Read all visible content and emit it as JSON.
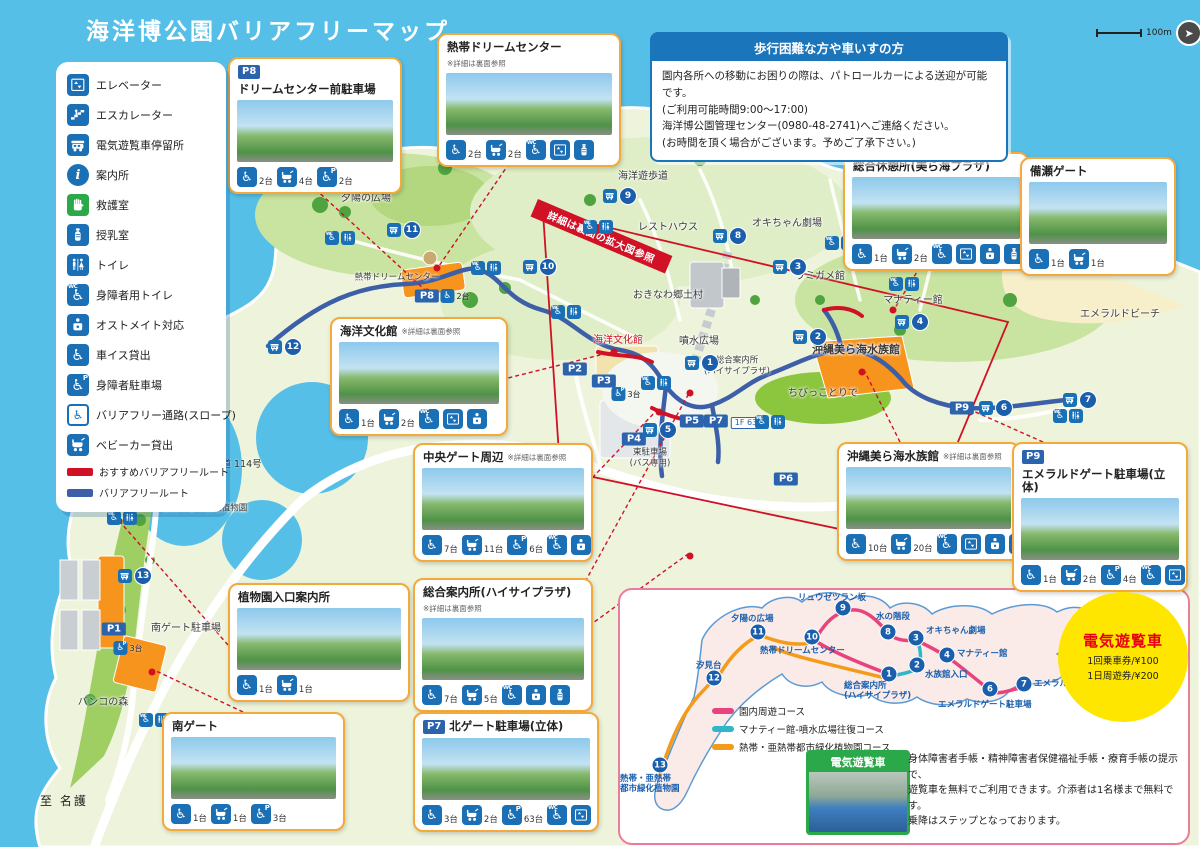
{
  "title": "海洋博公園バリアフリーマップ",
  "scale": {
    "label": "100m"
  },
  "colors": {
    "sea": "#56BFE8",
    "icon_blue": "#1B6FB5",
    "badge_blue": "#2B63AD",
    "recommended_route": "#D01126",
    "barrier_free_route": "#3D5FA8",
    "callout_border": "#F3A93C",
    "fare_circle": "#FFE600",
    "fare_title": "#E60012"
  },
  "legend": {
    "items": [
      {
        "icon": "elevator",
        "label": "エレベーター"
      },
      {
        "icon": "escalator",
        "label": "エスカレーター"
      },
      {
        "icon": "cart",
        "label": "電気遊覧車停留所"
      },
      {
        "icon": "info",
        "label": "案内所"
      },
      {
        "icon": "firstaid",
        "label": "救護室"
      },
      {
        "icon": "nursing",
        "label": "授乳室"
      },
      {
        "icon": "toilet",
        "label": "トイレ"
      },
      {
        "icon": "accessible-toilet",
        "label": "身障者用トイレ"
      },
      {
        "icon": "ostomate",
        "label": "オストメイト対応"
      },
      {
        "icon": "wheelchair",
        "label": "車イス貸出"
      },
      {
        "icon": "accessible-parking",
        "label": "身障者駐車場"
      },
      {
        "icon": "slope",
        "label": "バリアフリー通路(スロープ)"
      },
      {
        "icon": "stroller",
        "label": "ベビーカー貸出"
      }
    ],
    "routes": [
      {
        "label": "おすすめバリアフリールート",
        "color": "#D01126"
      },
      {
        "label": "バリアフリールート",
        "color": "#3D5FA8"
      }
    ]
  },
  "notice": {
    "title": "歩行困難な方や車いすの方",
    "lines": [
      "園内各所への移動にお困りの際は、パトロールカーによる送迎が可能です。",
      "(ご利用可能時間9:00〜17:00)",
      "海洋博公園管理センター(0980-48-2741)へご連絡ください。",
      "(お時間を頂く場合がございます。予めご了承下さい。)"
    ]
  },
  "map": {
    "zoom_banner": "詳細は裏面の拡大図参照",
    "edge_labels": {
      "to_nago": "至 名護",
      "to_nakijin": "至 今帰仁",
      "kendo_badge": "14",
      "kendo": "県道 114号"
    },
    "labels": [
      {
        "text": "夕陽の広場",
        "x": 366,
        "y": 199,
        "cls": ""
      },
      {
        "text": "熱帯ドリームセンター",
        "x": 397,
        "y": 278,
        "cls": "small"
      },
      {
        "text": "海洋遊歩道",
        "x": 643,
        "y": 177,
        "cls": ""
      },
      {
        "text": "レストハウス",
        "x": 668,
        "y": 228,
        "cls": ""
      },
      {
        "text": "オキちゃん劇場",
        "x": 787,
        "y": 224,
        "cls": ""
      },
      {
        "text": "ウミガメ館",
        "x": 820,
        "y": 277,
        "cls": ""
      },
      {
        "text": "マナティー館",
        "x": 913,
        "y": 301,
        "cls": ""
      },
      {
        "text": "おきなわ郷土村",
        "x": 668,
        "y": 296,
        "cls": ""
      },
      {
        "text": "海洋文化館",
        "x": 618,
        "y": 341,
        "cls": "red"
      },
      {
        "text": "噴水広場",
        "x": 699,
        "y": 342,
        "cls": ""
      },
      {
        "text": "総合案内所\n(ハイサイプラザ)",
        "x": 737,
        "y": 366,
        "cls": "small"
      },
      {
        "text": "沖縄美ら海水族館",
        "x": 856,
        "y": 350,
        "cls": "bold"
      },
      {
        "text": "ちびっことりで",
        "x": 823,
        "y": 394,
        "cls": ""
      },
      {
        "text": "エメラルドビーチ",
        "x": 1120,
        "y": 315,
        "cls": ""
      },
      {
        "text": "東駐車場\n(バス専用)",
        "x": 650,
        "y": 458,
        "cls": "small"
      },
      {
        "text": "熱帯・亜熱帯都市緑化植物園",
        "x": 192,
        "y": 509,
        "cls": "small"
      },
      {
        "text": "南ゲート駐車場",
        "x": 186,
        "y": 629,
        "cls": ""
      },
      {
        "text": "バンコの森",
        "x": 103,
        "y": 703,
        "cls": ""
      },
      {
        "text": "1F 63台",
        "x": 750,
        "y": 423,
        "cls": "whitebox"
      }
    ],
    "parking_badges": [
      {
        "id": "P1",
        "x": 114,
        "y": 629
      },
      {
        "id": "P2",
        "x": 575,
        "y": 369
      },
      {
        "id": "P3",
        "x": 604,
        "y": 381
      },
      {
        "id": "P4",
        "x": 634,
        "y": 439
      },
      {
        "id": "P5",
        "x": 692,
        "y": 421
      },
      {
        "id": "P6",
        "x": 786,
        "y": 479
      },
      {
        "id": "P7",
        "x": 716,
        "y": 421
      },
      {
        "id": "P8",
        "x": 427,
        "y": 296
      },
      {
        "id": "P9",
        "x": 962,
        "y": 408
      }
    ],
    "extra_counts": [
      {
        "icon": "accessible-parking",
        "text": "3台",
        "x": 626,
        "y": 394
      },
      {
        "icon": "accessible-parking",
        "text": "3台",
        "x": 128,
        "y": 648
      },
      {
        "icon": "wheelchair",
        "text": "2台",
        "x": 455,
        "y": 296
      }
    ],
    "stops": [
      {
        "no": "1",
        "x": 702,
        "y": 363
      },
      {
        "no": "2",
        "x": 810,
        "y": 337
      },
      {
        "no": "3",
        "x": 790,
        "y": 267
      },
      {
        "no": "4",
        "x": 912,
        "y": 322
      },
      {
        "no": "5",
        "x": 660,
        "y": 430
      },
      {
        "no": "6",
        "x": 996,
        "y": 408
      },
      {
        "no": "7",
        "x": 1080,
        "y": 400
      },
      {
        "no": "8",
        "x": 730,
        "y": 236
      },
      {
        "no": "9",
        "x": 620,
        "y": 196
      },
      {
        "no": "10",
        "x": 540,
        "y": 267
      },
      {
        "no": "11",
        "x": 404,
        "y": 230
      },
      {
        "no": "12",
        "x": 285,
        "y": 347
      },
      {
        "no": "13",
        "x": 135,
        "y": 576
      }
    ],
    "icon_clusters": [
      {
        "x": 340,
        "y": 238
      },
      {
        "x": 486,
        "y": 268
      },
      {
        "x": 598,
        "y": 227
      },
      {
        "x": 840,
        "y": 243
      },
      {
        "x": 656,
        "y": 383
      },
      {
        "x": 770,
        "y": 422
      },
      {
        "x": 122,
        "y": 518
      },
      {
        "x": 154,
        "y": 720
      },
      {
        "x": 932,
        "y": 249
      },
      {
        "x": 566,
        "y": 312
      },
      {
        "x": 904,
        "y": 284
      },
      {
        "x": 1068,
        "y": 416
      }
    ]
  },
  "callouts": [
    {
      "badge": "P8",
      "title": "ドリームセンター前駐車場",
      "note": "",
      "x": 228,
      "y": 57,
      "w": 156,
      "facilities": [
        {
          "icon": "wheelchair",
          "count": "2台"
        },
        {
          "icon": "stroller",
          "count": "4台"
        },
        {
          "icon": "accessible-parking",
          "count": "2台"
        }
      ]
    },
    {
      "badge": "",
      "title": "熱帯ドリームセンター",
      "note": "※詳細は裏面参照",
      "x": 437,
      "y": 33,
      "w": 166,
      "facilities": [
        {
          "icon": "wheelchair",
          "count": "2台"
        },
        {
          "icon": "stroller",
          "count": "2台"
        },
        {
          "icon": "accessible-toilet",
          "count": ""
        },
        {
          "icon": "elevator",
          "count": ""
        },
        {
          "icon": "nursing",
          "count": ""
        }
      ]
    },
    {
      "badge": "",
      "title": "総合休憩所(美ら海プラザ)",
      "note": "",
      "x": 843,
      "y": 152,
      "w": 168,
      "facilities": [
        {
          "icon": "wheelchair",
          "count": "1台"
        },
        {
          "icon": "stroller",
          "count": "2台"
        },
        {
          "icon": "accessible-toilet",
          "count": ""
        },
        {
          "icon": "elevator",
          "count": ""
        },
        {
          "icon": "ostomate",
          "count": ""
        },
        {
          "icon": "nursing",
          "count": ""
        }
      ]
    },
    {
      "badge": "",
      "title": "備瀬ゲート",
      "note": "",
      "x": 1020,
      "y": 157,
      "w": 138,
      "facilities": [
        {
          "icon": "wheelchair",
          "count": "1台"
        },
        {
          "icon": "stroller",
          "count": "1台"
        }
      ]
    },
    {
      "badge": "",
      "title": "海洋文化館",
      "note": "※詳細は裏面参照",
      "x": 330,
      "y": 317,
      "w": 160,
      "facilities": [
        {
          "icon": "wheelchair",
          "count": "1台"
        },
        {
          "icon": "stroller",
          "count": "2台"
        },
        {
          "icon": "accessible-toilet",
          "count": ""
        },
        {
          "icon": "elevator",
          "count": ""
        },
        {
          "icon": "ostomate",
          "count": ""
        }
      ]
    },
    {
      "badge": "",
      "title": "中央ゲート周辺",
      "note": "※詳細は裏面参照",
      "x": 413,
      "y": 443,
      "w": 162,
      "facilities": [
        {
          "icon": "wheelchair",
          "count": "7台"
        },
        {
          "icon": "stroller",
          "count": "11台"
        },
        {
          "icon": "accessible-parking",
          "count": "6台"
        },
        {
          "icon": "accessible-toilet",
          "count": ""
        },
        {
          "icon": "ostomate",
          "count": ""
        }
      ]
    },
    {
      "badge": "",
      "title": "沖縄美ら海水族館",
      "note": "※詳細は裏面参照",
      "x": 837,
      "y": 442,
      "w": 165,
      "facilities": [
        {
          "icon": "wheelchair",
          "count": "10台"
        },
        {
          "icon": "stroller",
          "count": "20台"
        },
        {
          "icon": "accessible-toilet",
          "count": ""
        },
        {
          "icon": "elevator",
          "count": ""
        },
        {
          "icon": "ostomate",
          "count": ""
        },
        {
          "icon": "nursing",
          "count": ""
        }
      ]
    },
    {
      "badge": "P9",
      "title": "エメラルドゲート駐車場(立体)",
      "note": "",
      "x": 1012,
      "y": 442,
      "w": 158,
      "facilities": [
        {
          "icon": "wheelchair",
          "count": "1台"
        },
        {
          "icon": "stroller",
          "count": "2台"
        },
        {
          "icon": "accessible-parking",
          "count": "4台"
        },
        {
          "icon": "accessible-toilet",
          "count": ""
        },
        {
          "icon": "elevator",
          "count": ""
        }
      ]
    },
    {
      "badge": "",
      "title": "植物園入口案内所",
      "note": "",
      "x": 228,
      "y": 583,
      "w": 164,
      "facilities": [
        {
          "icon": "wheelchair",
          "count": "1台"
        },
        {
          "icon": "stroller",
          "count": "1台"
        }
      ]
    },
    {
      "badge": "",
      "title": "総合案内所(ハイサイプラザ)",
      "note": "※詳細は裏面参照",
      "x": 413,
      "y": 578,
      "w": 162,
      "facilities": [
        {
          "icon": "wheelchair",
          "count": "7台"
        },
        {
          "icon": "stroller",
          "count": "5台"
        },
        {
          "icon": "accessible-toilet",
          "count": ""
        },
        {
          "icon": "ostomate",
          "count": ""
        },
        {
          "icon": "nursing",
          "count": ""
        }
      ]
    },
    {
      "badge": "",
      "title": "南ゲート",
      "note": "",
      "x": 162,
      "y": 712,
      "w": 165,
      "facilities": [
        {
          "icon": "wheelchair",
          "count": "1台"
        },
        {
          "icon": "stroller",
          "count": "1台"
        },
        {
          "icon": "accessible-parking",
          "count": "3台"
        }
      ]
    },
    {
      "badge": "P7",
      "title": "北ゲート駐車場(立体)",
      "note": "",
      "x": 413,
      "y": 712,
      "w": 168,
      "facilities": [
        {
          "icon": "wheelchair",
          "count": "3台"
        },
        {
          "icon": "stroller",
          "count": "2台"
        },
        {
          "icon": "accessible-parking",
          "count": "63台"
        },
        {
          "icon": "accessible-toilet",
          "count": ""
        },
        {
          "icon": "elevator",
          "count": ""
        }
      ]
    }
  ],
  "route_panel": {
    "fare_circle": {
      "title": "電気遊覧車",
      "fares": [
        "1回乗車券/¥100",
        "1日周遊券/¥200"
      ]
    },
    "courses": [
      {
        "label": "園内周遊コース",
        "color": "#E8437C"
      },
      {
        "label": "マナティー館-噴水広場往復コース",
        "color": "#2FB6C9"
      },
      {
        "label": "熱帯・亜熱帯都市緑化植物園コース",
        "color": "#F49B1B"
      }
    ],
    "mini_stops": [
      {
        "no": "1",
        "x": 889,
        "y": 674,
        "name": "総合案内所\n(ハイサイプラザ)",
        "lx": 844,
        "ly": 681
      },
      {
        "no": "2",
        "x": 917,
        "y": 665,
        "name": "水族館入口",
        "lx": 925,
        "ly": 670
      },
      {
        "no": "3",
        "x": 916,
        "y": 638,
        "name": "オキちゃん劇場",
        "lx": 926,
        "ly": 626
      },
      {
        "no": "4",
        "x": 947,
        "y": 655,
        "name": "マナティー館",
        "lx": 957,
        "ly": 649
      },
      {
        "no": "6",
        "x": 990,
        "y": 689,
        "name": "エメラルドゲート駐車場",
        "lx": 938,
        "ly": 700
      },
      {
        "no": "7",
        "x": 1024,
        "y": 684,
        "name": "エメラルドビーチ",
        "lx": 1034,
        "ly": 679
      },
      {
        "no": "8",
        "x": 888,
        "y": 632,
        "name": "水の階段",
        "lx": 876,
        "ly": 612
      },
      {
        "no": "9",
        "x": 843,
        "y": 608,
        "name": "リュウゼツラン坂",
        "lx": 798,
        "ly": 593
      },
      {
        "no": "10",
        "x": 812,
        "y": 637,
        "name": "熱帯ドリームセンター",
        "lx": 760,
        "ly": 646
      },
      {
        "no": "11",
        "x": 758,
        "y": 632,
        "name": "夕陽の広場",
        "lx": 731,
        "ly": 614
      },
      {
        "no": "12",
        "x": 714,
        "y": 678,
        "name": "汐見台",
        "lx": 696,
        "ly": 661
      },
      {
        "no": "13",
        "x": 660,
        "y": 765,
        "name": "熱帯・亜熱帯\n都市緑化植物園",
        "lx": 620,
        "ly": 774
      }
    ],
    "bus_label": "電気遊覧車",
    "note_lines": [
      "身体障害者手帳・精神障害者保健福祉手帳・療育手帳の提示で、",
      "遊覧車を無料でご利用できます。介添者は1名様まで無料です。",
      "乗降はステップとなっております。"
    ]
  }
}
